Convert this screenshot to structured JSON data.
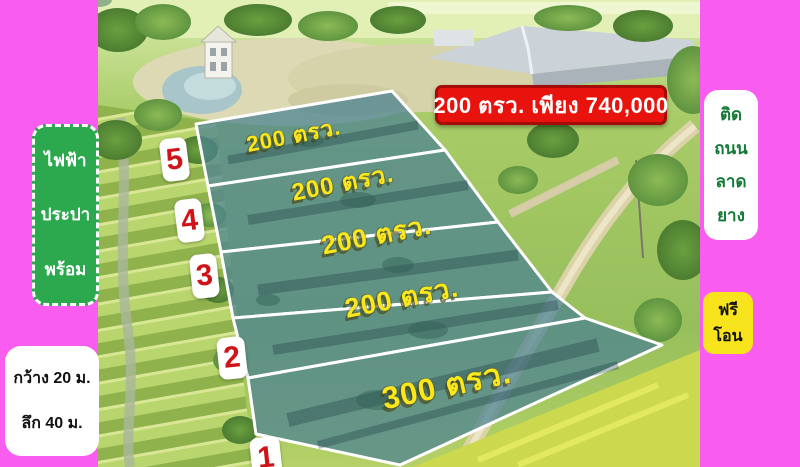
{
  "colors": {
    "frame_pink": "#f95def",
    "banner_bg": "#e8130c",
    "banner_border": "#a50b08",
    "utilities_green": "#2ca84f",
    "free_transfer_yellow": "#f8e41d",
    "plot_overlay_teal": "#4d8391",
    "plot_label_yellow": "#fbe71a",
    "badge_number_red": "#cf1318",
    "road_text_green": "#157a36"
  },
  "price_banner": {
    "text": "200 ตรว. เพียง 740,000"
  },
  "utilities_box": {
    "lines": [
      "ไฟฟ้า",
      "ประปา",
      "พร้อม"
    ]
  },
  "dimensions_box": {
    "lines": [
      "กว้าง 20 ม.",
      "ลึก 40 ม."
    ]
  },
  "road_box": {
    "lines": [
      "ติด",
      "ถนน",
      "ลาด",
      "ยาง"
    ]
  },
  "free_transfer_box": {
    "lines": [
      "ฟรี",
      "โอน"
    ]
  },
  "plots": [
    {
      "number": "5",
      "area_label": "200 ตรว."
    },
    {
      "number": "4",
      "area_label": "200 ตรว."
    },
    {
      "number": "3",
      "area_label": "200 ตรว."
    },
    {
      "number": "2",
      "area_label": "200 ตรว."
    },
    {
      "number": "1",
      "area_label": "300 ตรว."
    }
  ]
}
